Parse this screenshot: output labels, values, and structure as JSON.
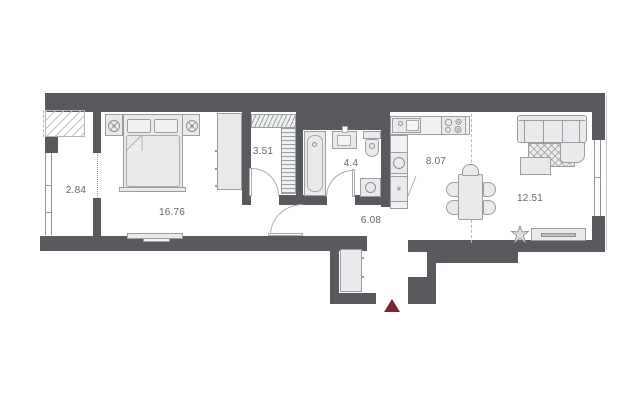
{
  "plan": {
    "rooms": [
      {
        "key": "balcony",
        "label": "2.84"
      },
      {
        "key": "bedroom",
        "label": "16.76"
      },
      {
        "key": "closet",
        "label": "3.51"
      },
      {
        "key": "bathroom",
        "label": "4.4"
      },
      {
        "key": "hallway",
        "label": "6.08"
      },
      {
        "key": "kitchen",
        "label": "8.07"
      },
      {
        "key": "living_room",
        "label": "12.51"
      }
    ],
    "symbols": {
      "fridge": "*"
    },
    "colors": {
      "wall": "#595a5d",
      "fill": "#e9eaeb",
      "stroke": "#9b9da0",
      "label": "#636568",
      "entrance": "#7c2334",
      "floor": "#ffffff"
    }
  }
}
